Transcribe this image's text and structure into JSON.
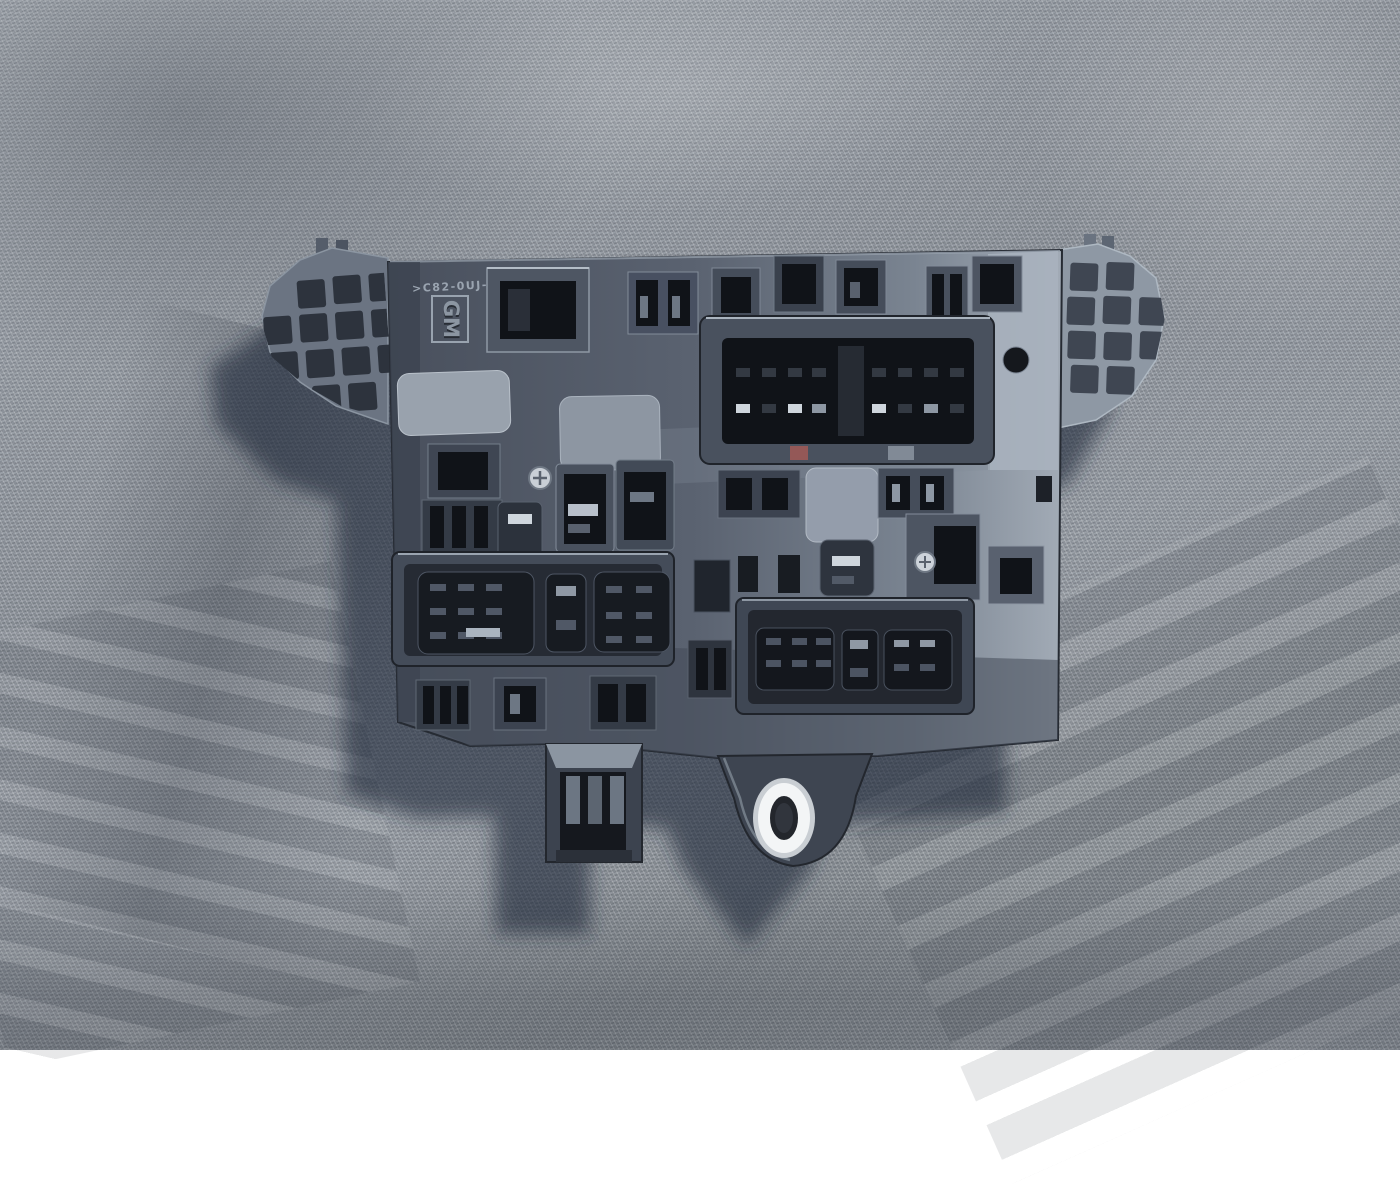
{
  "scene": {
    "description": "Dark grey GM fuse-relay box module (underside) lying on a grey woven tarp in sunlight"
  },
  "part": {
    "logo_text": "GM",
    "marking_text": ">C82-0UJ-41B<"
  },
  "colors": {
    "fabric_base": "#8f959d",
    "fabric_highlight": "#c2c8ce",
    "fabric_shadow": "#5d646e",
    "cast_shadow": "#1f2738",
    "plastic_dark": "#2b303a",
    "plastic_mid": "#4a5260",
    "plastic_light": "#6e7885",
    "plastic_sunlit": "#a6afba",
    "cavity_black": "#101318",
    "slot_grey": "#333942",
    "pin_glint": "#cfd6dd",
    "bushing_silver": "#f3f5f6",
    "red_marking": "#a85a55"
  }
}
